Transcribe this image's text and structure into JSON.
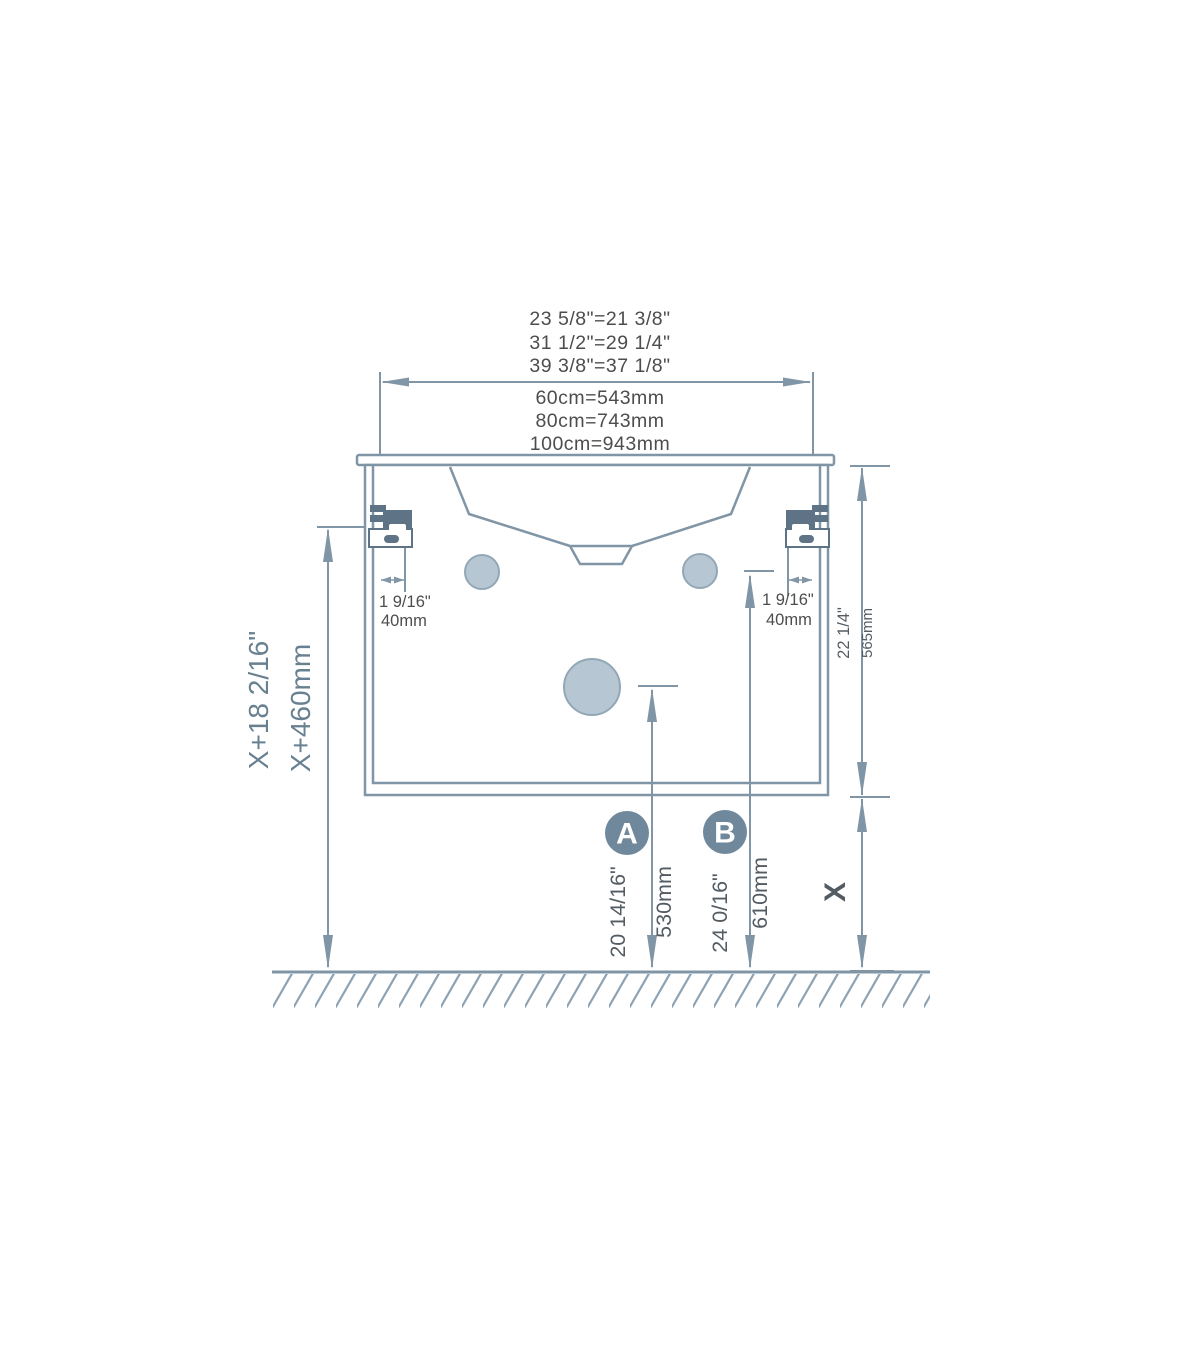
{
  "title": "Wall-hung vanity installation dimension diagram",
  "colors": {
    "line": "#8096a7",
    "bracket_fill": "#5e7486",
    "hole_fill": "#b6c6d3",
    "hole_stroke": "#93a8b6",
    "badge_fill": "#70889b",
    "text_dark": "#4d4d4d",
    "text_slate": "#68808f",
    "text_dim": "#545c63"
  },
  "width_dimension": {
    "inches": [
      "23 5/8\"=21 3/8\"",
      "31 1/2\"=29 1/4\"",
      "39 3/8\"=37 1/8\""
    ],
    "metric": [
      "60cm=543mm",
      "80cm=743mm",
      "100cm=943mm"
    ]
  },
  "bracket_offset": {
    "inches": "1 9/16\"",
    "metric": "40mm"
  },
  "mounting_height": {
    "inches": "X+18 2/16\"",
    "metric": "X+460mm"
  },
  "cabinet_height": {
    "inches": "22 1/4\"",
    "metric": "565mm"
  },
  "floor_clearance": {
    "label": "X"
  },
  "marker_a": {
    "label": "A",
    "inches": "20 14/16\"",
    "metric": "530mm"
  },
  "marker_b": {
    "label": "B",
    "inches": "24 0/16\"",
    "metric": "610mm"
  }
}
